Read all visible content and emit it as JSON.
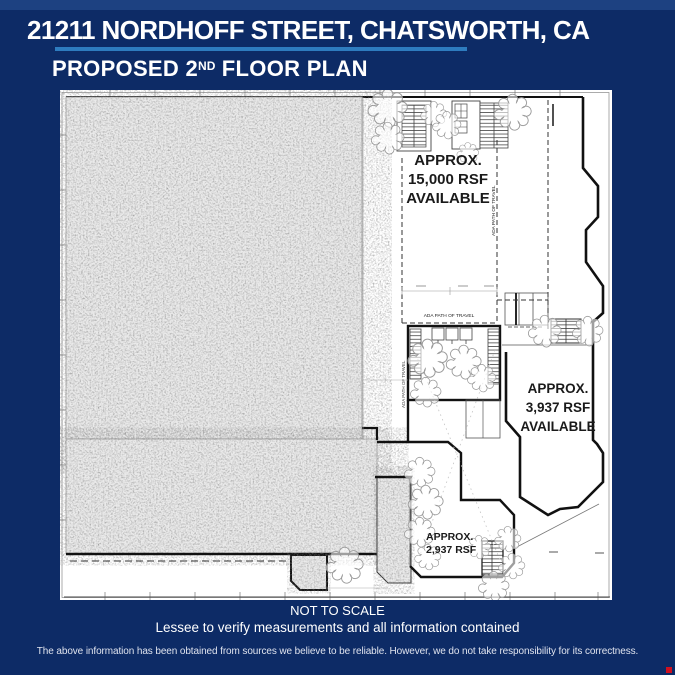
{
  "colors": {
    "navy": "#0d2b66",
    "top-strip": "#1d4181",
    "divider": "#2e7cbf",
    "plan-bg": "#ffffff",
    "ink": "#1a1a1a",
    "accent-red": "#cf1020"
  },
  "header": {
    "address": "21211 NORDHOFF STREET, CHATSWORTH, CA",
    "plan_title_main": "PROPOSED 2",
    "plan_title_sup": "ND",
    "plan_title_rest": " FLOOR PLAN"
  },
  "plan": {
    "labels": {
      "suite_large": {
        "line1": "APPROX.",
        "line2": "15,000 RSF",
        "line3": "AVAILABLE"
      },
      "suite_mid": {
        "line1": "APPROX.",
        "line2": "3,937 RSF",
        "line3": "AVAILABLE"
      },
      "suite_small": {
        "line1": "APPROX.",
        "line2": "2,937 RSF"
      },
      "ada_path": "ADA PATH OF TRAVEL"
    }
  },
  "footer": {
    "scale_note": "NOT TO SCALE",
    "verify_note": "Lessee to verify measurements and all information contained",
    "disclaimer": "The above information has been obtained from sources we believe to be reliable.  However, we do not take responsibility for its correctness."
  }
}
